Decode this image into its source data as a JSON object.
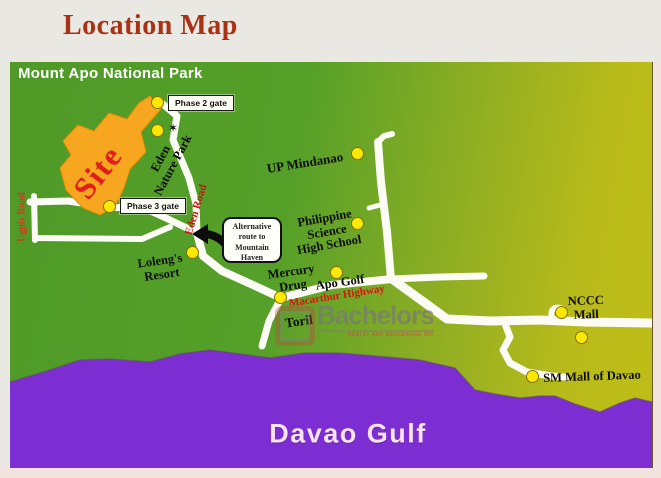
{
  "title": "Location Map",
  "map": {
    "park_label": "Mount Apo National Park",
    "water_label": "Davao Gulf",
    "site_label": "Site",
    "gates": {
      "phase2": "Phase 2 gate",
      "phase3": "Phase 3 gate"
    },
    "roads": {
      "ugpis": "Ugpis Road",
      "eden": "Eden Road",
      "macarthur": "Macarthur Highway"
    },
    "places": {
      "eden_park": {
        "line1": "Eden",
        "line2": "Nature Park"
      },
      "up_mindanao": "UP Mindanao",
      "science_hs": {
        "line1": "Philippine",
        "line2": "Science",
        "line3": "High School"
      },
      "lolengs": {
        "line1": "Loleng's",
        "line2": "Resort"
      },
      "mercury": {
        "line1": "Mercury",
        "line2": "Drug"
      },
      "apo_golf": "Apo Golf",
      "toril": "Toril",
      "nccc": {
        "line1": "NCCC",
        "line2": "Mall"
      },
      "sm_mall": "SM Mall of Davao"
    },
    "callout": {
      "line1": "Alternative",
      "line2": "route to",
      "line3": "Mountain",
      "line4": "Haven"
    },
    "colors": {
      "title_red": "#a93114",
      "map_green": "#519b27",
      "map_olive": "#b9ba1b",
      "water_purple": "#7c2ed2",
      "site_orange": "#f6a71f",
      "road_white": "#fcfcf4",
      "marker_yellow": "#ffe800",
      "road_label_red": "#cf1212"
    }
  },
  "watermark": {
    "name": "Bachelors",
    "tagline": "REALTY AND BROKERAGE INC"
  }
}
